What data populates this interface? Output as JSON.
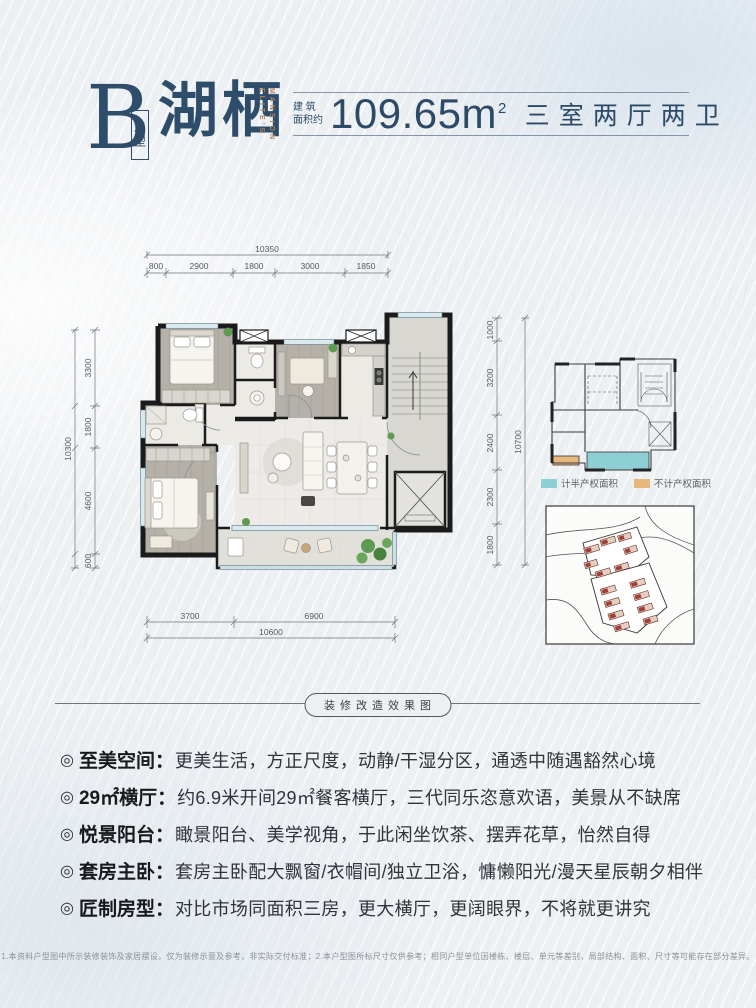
{
  "header": {
    "type_letter": "B",
    "type_label": "户型",
    "name": "湖栖",
    "name_en_1": "ELITE'S",
    "name_en_2": "MANSION",
    "area_label": "建 筑\n面积约",
    "area_value": "109.65m",
    "area_sup": "2",
    "rooms": "三室两厅两卫"
  },
  "floorplan": {
    "dims": {
      "top_total": "10350",
      "top": [
        "800",
        "2900",
        "1800",
        "3000",
        "1850"
      ],
      "left_total": "10300",
      "left": [
        "3300",
        "1800",
        "4600",
        "600"
      ],
      "right_total": "10700",
      "right": [
        "1000",
        "3200",
        "2400",
        "2300",
        "1800"
      ],
      "bottom": [
        "3700",
        "6900"
      ],
      "bottom_total": "10600"
    }
  },
  "legend": {
    "items": [
      {
        "label": "计半产权面积",
        "color": "#8ecfd6"
      },
      {
        "label": "不计产权面积",
        "color": "#e6b87e"
      }
    ]
  },
  "divider": {
    "label": "装修改造效果图"
  },
  "features": {
    "bullet": "◎",
    "colon": "：",
    "items": [
      {
        "label": "至美空间",
        "text": "更美生活，方正尺度，动静/干湿分区，通透中随遇豁然心境"
      },
      {
        "label": "29㎡横厅",
        "text": "约6.9米开间29㎡餐客横厅，三代同乐恣意欢语，美景从不缺席"
      },
      {
        "label": "悦景阳台",
        "text": "瞰景阳台、美学视角，于此闲坐饮茶、摆弄花草，怡然自得"
      },
      {
        "label": "套房主卧",
        "text": "套房主卧配大飘窗/衣帽间/独立卫浴，慵懒阳光/漫天星辰朝夕相伴"
      },
      {
        "label": "匠制房型",
        "text": "对比市场同面积三房，更大横厅，更阔眼界，不将就更讲究"
      }
    ]
  },
  "disclaimer": "1.本资料户型图中所示装修装饰及家居摆设，仅为装修示意及参考，非实际交付标准；2.本户型图所标尺寸仅供参考；相同户型单位因楼栋、楼层、单元等差别，局部结构、面积、尺寸等可能存在部分差异。",
  "colors": {
    "navy": "#2e4d6b",
    "accent_orange": "#b2805a",
    "teal": "#8ecfd6",
    "tan": "#e6b87e"
  }
}
